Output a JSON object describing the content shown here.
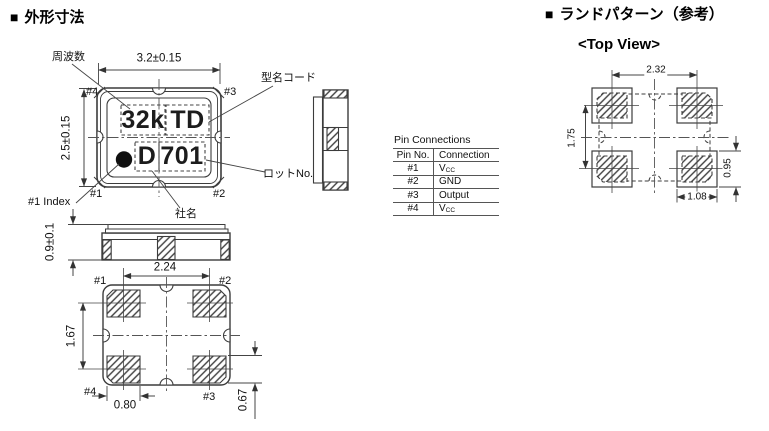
{
  "headings": {
    "outline_marker": "■",
    "outline_title": "外形寸法",
    "land_marker": "■",
    "land_title": "ランドパターン（参考）",
    "top_view": "<Top View>"
  },
  "annotations": {
    "frequency": "周波数",
    "model_code": "型名コード",
    "lot_no": "ロットNo.",
    "company": "社名",
    "index": "#1 Index"
  },
  "marking": {
    "freq": "32k",
    "code": "TD",
    "company": "D",
    "lot": "701"
  },
  "pins": {
    "p1": "#1",
    "p2": "#2",
    "p3": "#3",
    "p4": "#4"
  },
  "dimensions": {
    "body_width": "3.2±0.15",
    "body_height": "2.5±0.15",
    "thickness": "0.9±0.1",
    "pad_span_x": "2.24",
    "pad_span_y": "1.67",
    "pad_width": "0.80",
    "pad_height": "0.67"
  },
  "land_pattern": {
    "pitch_x": "2.32",
    "pitch_y": "1.75",
    "pad_height": "0.95",
    "pad_width": "1.08"
  },
  "pin_table": {
    "title": "Pin Connections",
    "headers": [
      "Pin No.",
      "Connection"
    ],
    "rows": [
      {
        "pin": "#1",
        "conn": "V",
        "sub": "CC"
      },
      {
        "pin": "#2",
        "conn": "GND",
        "sub": ""
      },
      {
        "pin": "#3",
        "conn": "Output",
        "sub": ""
      },
      {
        "pin": "#4",
        "conn": "V",
        "sub": "CC"
      }
    ]
  }
}
